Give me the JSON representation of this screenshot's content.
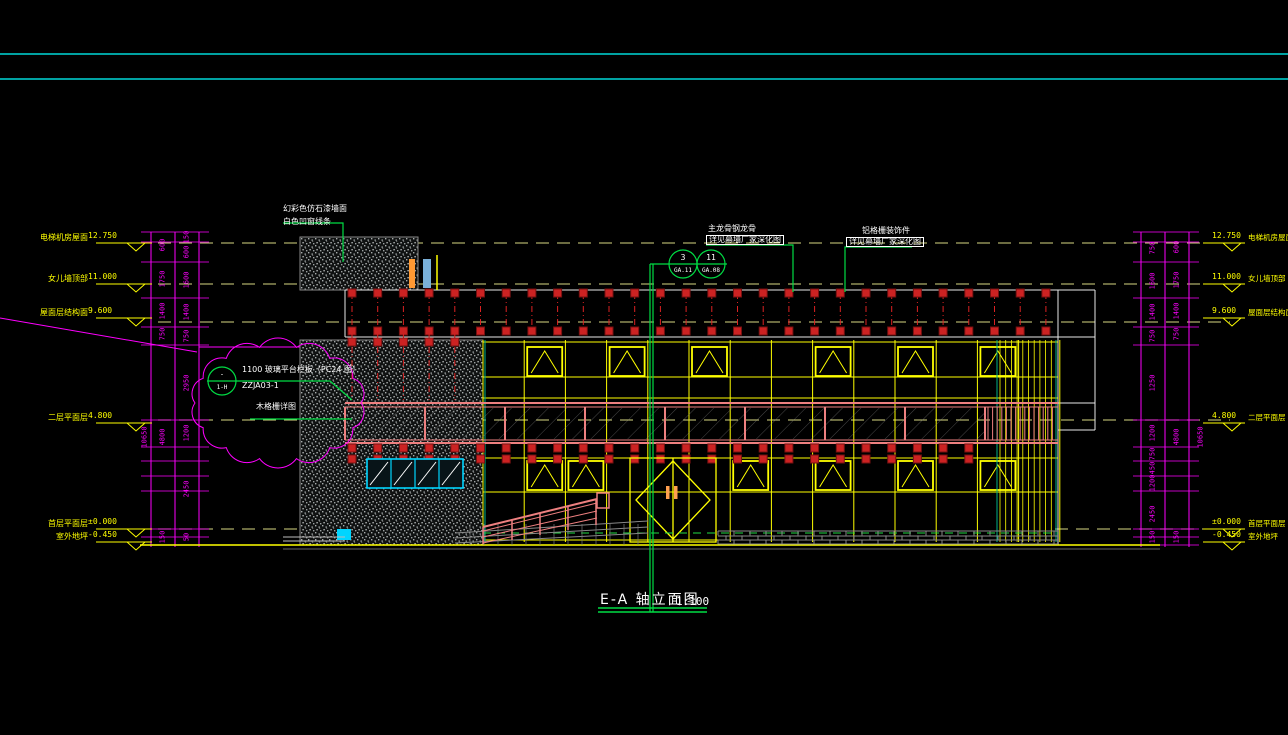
{
  "title": {
    "text": "E-A 轴立面图",
    "scale": "1:100"
  },
  "levels_left": [
    {
      "label": "电梯机房屋面",
      "value": "12.750"
    },
    {
      "label": "女儿墙顶部",
      "value": "11.000"
    },
    {
      "label": "屋面层结构面",
      "value": "9.600"
    },
    {
      "label": "二层平面层",
      "value": "4.800"
    },
    {
      "label": "首层平面层",
      "value": "±0.000"
    },
    {
      "label": "室外地坪",
      "value": "-0.450"
    }
  ],
  "levels_right": [
    {
      "label": "电梯机房屋面",
      "value": "12.750"
    },
    {
      "label": "女儿墙顶部",
      "value": "11.000"
    },
    {
      "label": "屋面层结构面",
      "value": "9.600"
    },
    {
      "label": "二层平面层",
      "value": "4.800"
    },
    {
      "label": "首层平面层",
      "value": "±0.000"
    },
    {
      "label": "室外地坪",
      "value": "-0.450"
    }
  ],
  "annotations": {
    "wall_finish_1": "幻彩色仿石漆墙面",
    "wall_finish_2": "白色凹窗线条",
    "keel_1": "主龙骨钢龙骨",
    "keel_2": "详见幕墙厂家深化图",
    "grille_1": "铝格栅装饰件",
    "grille_2": "详见幕墙厂家深化图",
    "railing_1": "1100 玻璃平台栏板（PC24 图）",
    "railing_2": "ZZJA03-1",
    "grille_detail": "木格栅详图"
  },
  "bubbles": {
    "b1_top": "3",
    "b1_bottom": "GA.11",
    "b2_top": "11",
    "b2_bottom": "GA.08",
    "b3_top": "-",
    "b3_bottom": "1-H"
  },
  "dimensions": {
    "left_col_a": [
      "600",
      "1750",
      "1400",
      "750",
      "4800",
      "150"
    ],
    "left_col_b": [
      "150",
      "600",
      "1600",
      "1400",
      "750",
      "2950",
      "1200",
      "2450",
      "50"
    ],
    "left_total": "10650",
    "right_col_a": [
      "750",
      "1600",
      "1400",
      "750",
      "1250",
      "1200",
      "750",
      "450",
      "1200",
      "2450",
      "150"
    ],
    "right_col_b": [
      "600",
      "1750",
      "1400",
      "750",
      "4800",
      "150"
    ],
    "right_total": "10650"
  },
  "colors": {
    "background": "#000000",
    "border_line": "#00d8d8",
    "dimension": "#ff00ff",
    "level_text": "#ffff00",
    "mullion": "#ffff00",
    "fin": "#cc2222",
    "walkway": "#ee8080",
    "leader": "#00dd44",
    "hatch": "#a8adad",
    "window_frame": "#00d5ff",
    "annotation_text": "#ffffff"
  }
}
